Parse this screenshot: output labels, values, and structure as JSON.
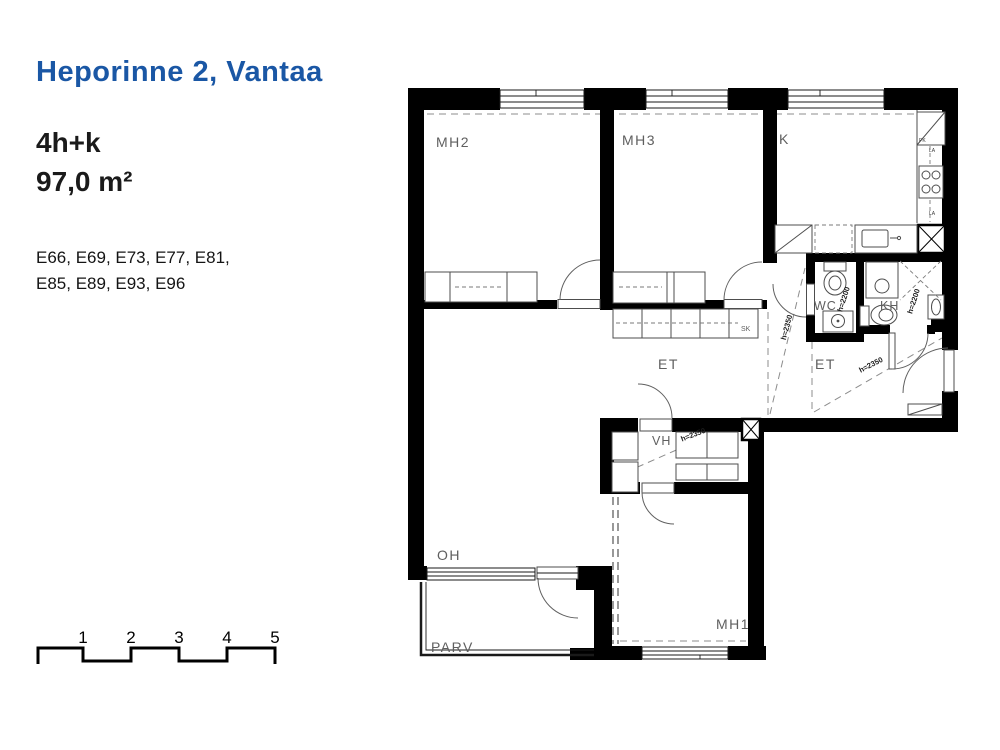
{
  "header": {
    "title": "Heporinne 2, Vantaa",
    "apartment_type": "4h+k",
    "area": "97,0 m²",
    "unit_numbers_line1": "E66, E69, E73, E77, E81,",
    "unit_numbers_line2": "E85, E89, E93, E96"
  },
  "floorplan": {
    "room_labels": {
      "mh2": "MH2",
      "mh3": "MH3",
      "k": "K",
      "wc": "WC",
      "kh": "KH",
      "et1": "ET",
      "et2": "ET",
      "vh": "VH",
      "oh": "OH",
      "parv": "PARV",
      "mh1": "MH1",
      "sk": "SK"
    },
    "height_labels": {
      "wc": "h=2200",
      "kh": "h=2200",
      "et1": "h=2350",
      "et2": "h=2350",
      "vh": "h=2350"
    },
    "appliance_labels": {
      "pk": "PK",
      "la1": "LA",
      "la2": "LA"
    },
    "colors": {
      "wall": "#000000",
      "accent_blue": "#1a57a5",
      "label_gray": "#5f5f5f"
    }
  },
  "scale_bar": {
    "numbers": [
      "1",
      "2",
      "3",
      "4",
      "5"
    ]
  }
}
